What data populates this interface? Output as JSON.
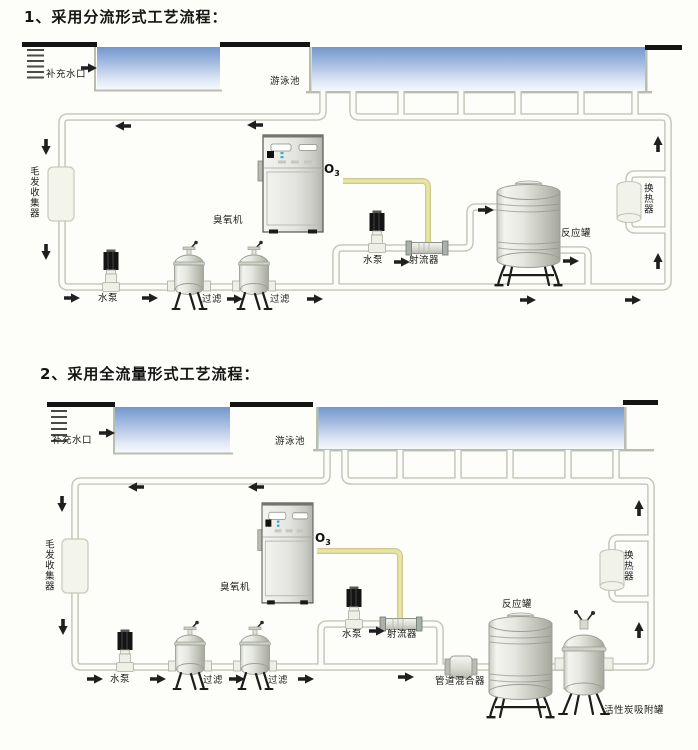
{
  "colors": {
    "pipe_outline": "#c3c6b7",
    "pipe_fill": "#fcfcf8",
    "ozone_pipe": "#e8e4a8",
    "water_top": "#7397cc",
    "water_bottom": "#f7fafd",
    "deck_bar": "#141414",
    "arrow": "#1f1f1f",
    "text": "#1b1b1b"
  },
  "diagram1": {
    "title": "1、采用分流形式工艺流程：",
    "labels": {
      "makeup_inlet": "补充水口",
      "pool": "游泳池",
      "hair_collector": "毛发收集器",
      "pump_main": "水泵",
      "filter_a": "过滤",
      "filter_b": "过滤",
      "ozone_machine": "臭氧机",
      "o3_main": "O",
      "o3_sub": "3",
      "pump_jet": "水泵",
      "jet_injector": "射流器",
      "reaction_tank": "反应罐",
      "heat_exchanger": "换热器"
    }
  },
  "diagram2": {
    "title": "2、采用全流量形式工艺流程：",
    "labels": {
      "makeup_inlet": "补充水口",
      "pool": "游泳池",
      "hair_collector": "毛发收集器",
      "pump_main": "水泵",
      "filter_a": "过滤",
      "filter_b": "过滤",
      "ozone_machine": "臭氧机",
      "o3_main": "O",
      "o3_sub": "3",
      "pump_jet": "水泵",
      "jet_injector": "射流器",
      "pipeline_mixer": "管道混合器",
      "reaction_tank": "反应罐",
      "carbon_tank": "活性炭吸附罐",
      "heat_exchanger": "换热器"
    }
  }
}
